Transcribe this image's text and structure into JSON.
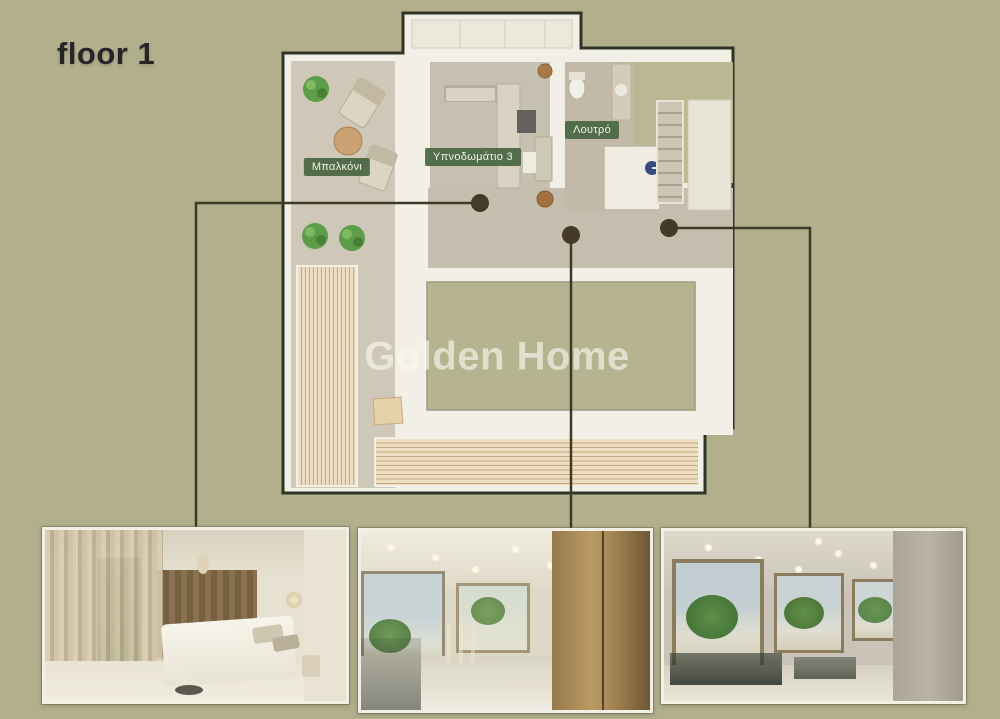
{
  "page": {
    "title": "floor 1",
    "watermark": "Golden Home",
    "background": "#b2b08c"
  },
  "floorplan": {
    "rooms": {
      "balcony": "Μπαλκόνι",
      "bedroom": "Υπνοδωμάτιο 3",
      "bathroom": "Λουτρό"
    },
    "colors": {
      "outline": "#2e3423",
      "walls": "#f1efe6",
      "label_background": "#4c6845",
      "label_text": "#f3f3e9",
      "connector_line": "#3e3a28",
      "callout_dot": "#453a28",
      "deck_wood": "#eedec4",
      "deck_wood_line": "#c9a87d",
      "void_area": "#b5b390",
      "plant_green": "#5d9c49"
    }
  },
  "thumbnails": [
    {
      "id": "bedroom-render",
      "description": "bedroom interior render"
    },
    {
      "id": "landing-render",
      "description": "landing hallway render"
    },
    {
      "id": "corridor-render",
      "description": "corridor with windows render"
    }
  ]
}
